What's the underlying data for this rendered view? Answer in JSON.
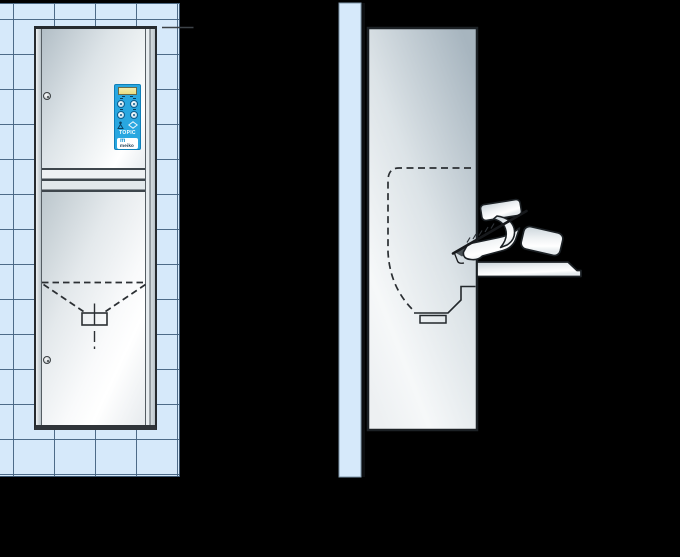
{
  "front_view": {
    "control_panel": {
      "brand": "TOPIC",
      "logo_symbol": "m",
      "logo_text": "meiko",
      "button_icons": [
        "program-button-1",
        "program-button-2",
        "program-button-3",
        "program-button-4"
      ],
      "symbol_icons": [
        "user-icon",
        "diamond-icon"
      ]
    },
    "lock_icons": [
      "lock-icon-upper",
      "lock-icon-lower"
    ],
    "door_markings": [
      "dashed-chute-outline",
      "handle-rectangle",
      "center-line"
    ]
  },
  "side_view": {
    "elements": [
      "wall-section",
      "washer-side-body",
      "chamber-outline-dashed",
      "drain-profile",
      "open-door-tray",
      "bedpan",
      "hand",
      "forearm"
    ]
  },
  "colors": {
    "background": "#000000",
    "tile": "#d6e9fa",
    "tile_grout": "#4c6882",
    "panel_blue": "#29a7e0",
    "display_yellow": "#efe79b",
    "metal_light": "#f6f8f9",
    "metal_shadow": "#a7b5bf",
    "outline": "#1c2125",
    "logo_blue": "#1593d2"
  }
}
